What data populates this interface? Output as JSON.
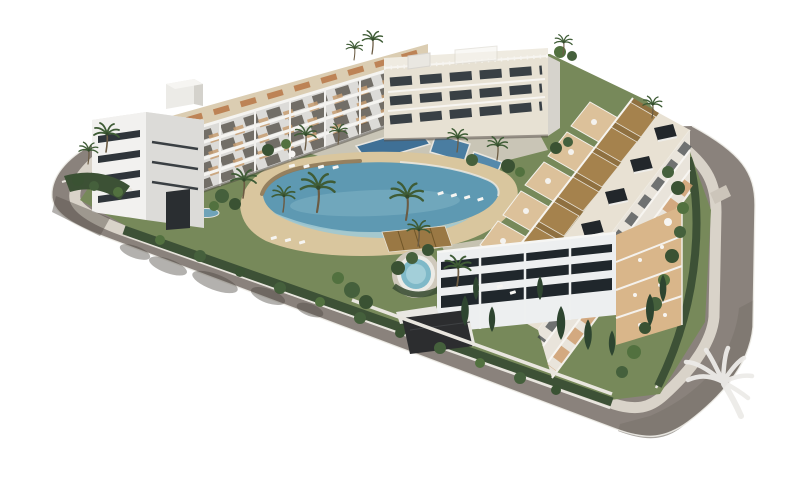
{
  "image": {
    "kind": "3d-architectural-render",
    "subject": "aerial-view-of-modern-apartment-complex-with-lagoon-pool-gardens-and-perimeter-road",
    "visible_text": ""
  },
  "colors": {
    "background": "#ffffff",
    "road": "#8a827c",
    "road_corner_shade": "#7b746d",
    "road_edge": "#f0eee9",
    "sidewalk": "#d9d3c9",
    "driveway": "#ccc5ba",
    "plot_green": "#77895a",
    "hedge_green": "#3d5136",
    "sand": "#d9c69e",
    "pool_deep": "#5e99b2",
    "pool_shallow": "#9fc8d1",
    "jacuzzi_water": "#7fb9c8",
    "building_white": "#f2f1ef",
    "building_cream": "#e7e1d3",
    "building_shadow_face": "#dcdbd8",
    "glass_dark": "#2b3135",
    "terrace_terracotta": "#c89a6e",
    "pergola_wood": "#a5824d",
    "roof_deck": "#e8e1d3",
    "crosswalk_white": "#ece9e2",
    "watermark": "#edebe8"
  },
  "watermark": {
    "icon": "palm-tree-icon",
    "position": "bottom-right"
  }
}
